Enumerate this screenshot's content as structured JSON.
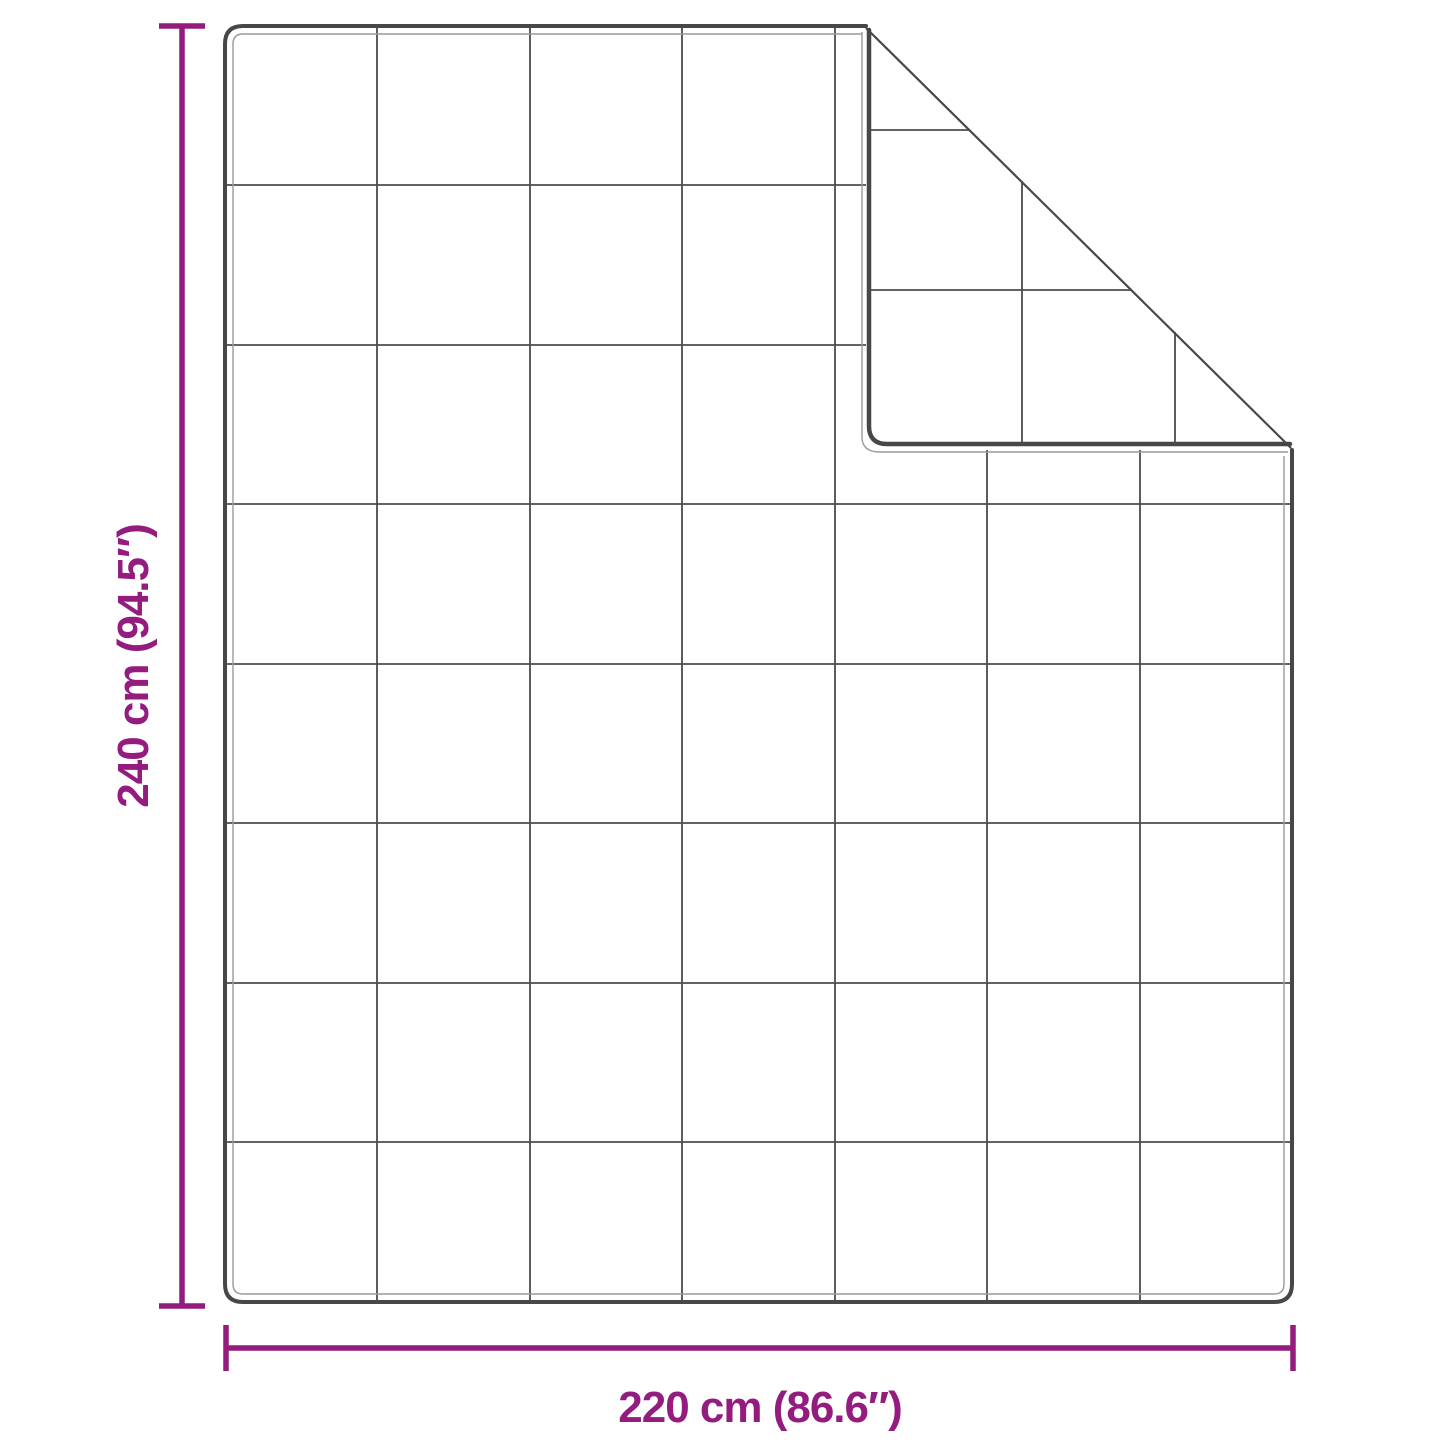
{
  "diagram": {
    "title": "blanket-dimension-diagram",
    "height_label": "240 cm (94.5″)",
    "width_label": "220 cm (86.6″)",
    "quilt_grid": {
      "columns": 7,
      "rows": 8,
      "folded_corner": "top-right"
    },
    "colors": {
      "dimension_accent": "#941c7f",
      "outline": "#474747",
      "grid_line": "#4d4d4d",
      "hem_line": "#9a9a9a",
      "background": "#ffffff"
    }
  }
}
